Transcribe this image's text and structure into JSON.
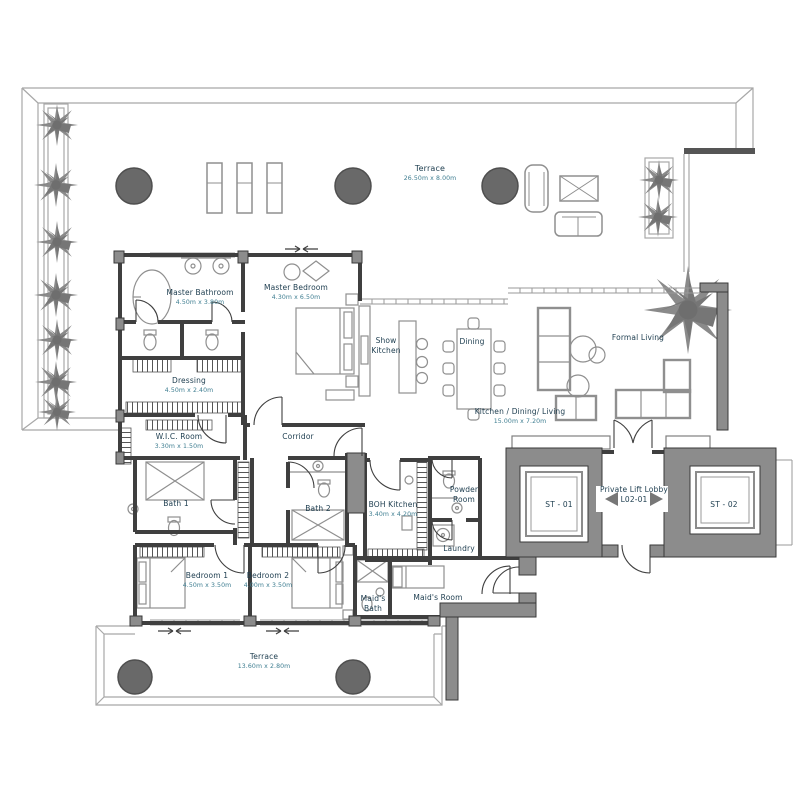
{
  "unit_code": "L02-01",
  "colors": {
    "room_name_text": "#1c3c4e",
    "room_dims_text": "#3f7e91",
    "wall": "#3f3f3f",
    "core_wall_fill": "#8c8c8c",
    "planter_fill": "#696969",
    "furniture_line": "#8f8f8f",
    "terrace_line": "#a8a8a8"
  },
  "icons": {
    "palm": "palm-plant-top-view",
    "planter": "round-planter",
    "lobby_direction": "left-right-triangle-arrows",
    "sliding_door": "opposing-arrows"
  },
  "rooms": {
    "terrace_top": {
      "name": "Terrace",
      "dims": "26.50m x 8.00m"
    },
    "master_bathroom": {
      "name": "Master Bathroom",
      "dims": "4.50m x 3.80m"
    },
    "master_bedroom": {
      "name": "Master Bedroom",
      "dims": "4.30m x 6.50m"
    },
    "show_kitchen": {
      "name": "Show\nKitchen"
    },
    "dining": {
      "name": "Dining"
    },
    "formal_living": {
      "name": "Formal Living"
    },
    "kitchen_dining_living": {
      "name": "Kitchen / Dining/ Living",
      "dims": "15.00m x 7.20m"
    },
    "dressing": {
      "name": "Dressing",
      "dims": "4.50m x 2.40m"
    },
    "wic_room": {
      "name": "W.I.C. Room",
      "dims": "3.30m x 1.50m"
    },
    "corridor": {
      "name": "Corridor"
    },
    "bath_1": {
      "name": "Bath 1"
    },
    "bath_2": {
      "name": "Bath 2"
    },
    "boh_kitchen": {
      "name": "BOH Kitchen",
      "dims": "3.40m x 4.20m"
    },
    "powder_room": {
      "name": "Powder\nRoom"
    },
    "laundry": {
      "name": "Laundry"
    },
    "bedroom_1": {
      "name": "Bedroom 1",
      "dims": "4.50m x 3.50m"
    },
    "bedroom_2": {
      "name": "Bedroom 2",
      "dims": "4.00m x 3.50m"
    },
    "maids_bath": {
      "name": "Maid's\nBath"
    },
    "maids_room": {
      "name": "Maid's Room"
    },
    "private_lift_lobby": {
      "name": "Private Lift Lobby\nL02-01"
    },
    "st_01": {
      "name": "ST - 01"
    },
    "st_02": {
      "name": "ST - 02"
    },
    "terrace_bottom": {
      "name": "Terrace",
      "dims": "13.60m x 2.80m"
    }
  }
}
